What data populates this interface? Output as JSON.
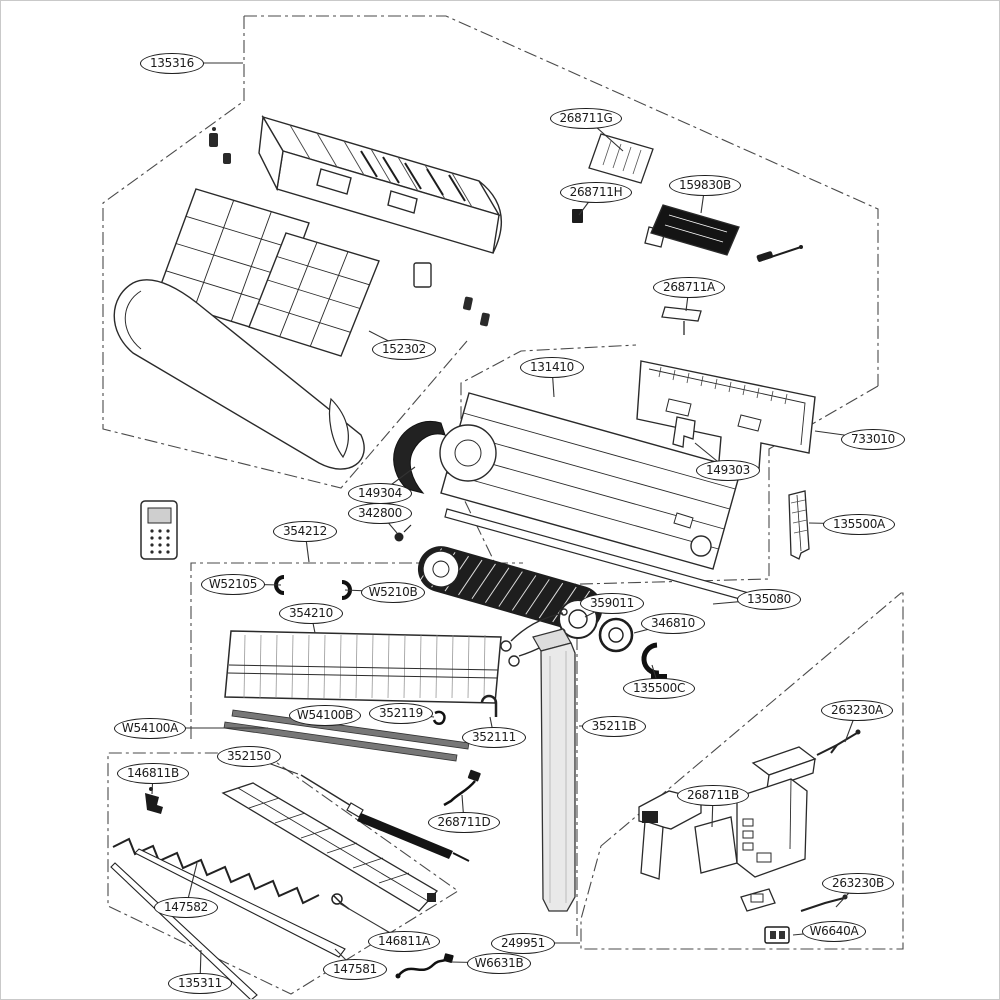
{
  "diagram": {
    "type": "exploded-parts-diagram",
    "labels": [
      {
        "text": "135316",
        "x": 171,
        "y": 62,
        "tx": 242,
        "ty": 62
      },
      {
        "text": "268711G",
        "x": 585,
        "y": 117,
        "tx": 622,
        "ty": 150
      },
      {
        "text": "268711H",
        "x": 595,
        "y": 191,
        "tx": 578,
        "ty": 214
      },
      {
        "text": "159830B",
        "x": 704,
        "y": 184,
        "tx": 700,
        "ty": 212
      },
      {
        "text": "268711A",
        "x": 688,
        "y": 286,
        "tx": 685,
        "ty": 310
      },
      {
        "text": "152302",
        "x": 403,
        "y": 348,
        "tx": 368,
        "ty": 330
      },
      {
        "text": "131410",
        "x": 551,
        "y": 366,
        "tx": 553,
        "ty": 396
      },
      {
        "text": "733010",
        "x": 872,
        "y": 438,
        "tx": 814,
        "ty": 430
      },
      {
        "text": "149303",
        "x": 727,
        "y": 469,
        "tx": 694,
        "ty": 442
      },
      {
        "text": "135500A",
        "x": 858,
        "y": 523,
        "tx": 808,
        "ty": 522
      },
      {
        "text": "149304",
        "x": 379,
        "y": 492,
        "tx": 414,
        "ty": 466
      },
      {
        "text": "342800",
        "x": 379,
        "y": 512,
        "tx": 396,
        "ty": 532
      },
      {
        "text": "354212",
        "x": 304,
        "y": 530,
        "tx": 308,
        "ty": 561
      },
      {
        "text": "W52105",
        "x": 232,
        "y": 583,
        "tx": 280,
        "ty": 584
      },
      {
        "text": "W5210B",
        "x": 392,
        "y": 591,
        "tx": 344,
        "ty": 589
      },
      {
        "text": "354210",
        "x": 310,
        "y": 612,
        "tx": 314,
        "ty": 632
      },
      {
        "text": "359011",
        "x": 611,
        "y": 602,
        "tx": 584,
        "ty": 616
      },
      {
        "text": "135080",
        "x": 768,
        "y": 598,
        "tx": 712,
        "ty": 603
      },
      {
        "text": "346810",
        "x": 672,
        "y": 622,
        "tx": 633,
        "ty": 632
      },
      {
        "text": "135500C",
        "x": 658,
        "y": 687,
        "tx": 651,
        "ty": 664
      },
      {
        "text": "35211B",
        "x": 613,
        "y": 725,
        "tx": 578,
        "ty": 725
      },
      {
        "text": "W54100B",
        "x": 324,
        "y": 714,
        "tx": 329,
        "ty": 722
      },
      {
        "text": "352119",
        "x": 400,
        "y": 712,
        "tx": 433,
        "ty": 716
      },
      {
        "text": "W54100A",
        "x": 149,
        "y": 727,
        "tx": 267,
        "ty": 727
      },
      {
        "text": "352111",
        "x": 493,
        "y": 736,
        "tx": 489,
        "ty": 716
      },
      {
        "text": "352150",
        "x": 248,
        "y": 755,
        "tx": 297,
        "ty": 773
      },
      {
        "text": "146811B",
        "x": 152,
        "y": 772,
        "tx": 151,
        "ty": 793
      },
      {
        "text": "268711D",
        "x": 463,
        "y": 821,
        "tx": 461,
        "ty": 794
      },
      {
        "text": "147582",
        "x": 185,
        "y": 906,
        "tx": 196,
        "ty": 862
      },
      {
        "text": "146811A",
        "x": 403,
        "y": 940,
        "tx": 338,
        "ty": 902
      },
      {
        "text": "147581",
        "x": 354,
        "y": 968,
        "tx": 334,
        "ty": 948
      },
      {
        "text": "135311",
        "x": 199,
        "y": 982,
        "tx": 200,
        "ty": 949
      },
      {
        "text": "263230A",
        "x": 856,
        "y": 709,
        "tx": 844,
        "ty": 741
      },
      {
        "text": "268711B",
        "x": 712,
        "y": 794,
        "tx": 711,
        "ty": 826
      },
      {
        "text": "263230B",
        "x": 857,
        "y": 882,
        "tx": 835,
        "ty": 906
      },
      {
        "text": "W6640A",
        "x": 833,
        "y": 930,
        "tx": 792,
        "ty": 934
      },
      {
        "text": "249951",
        "x": 522,
        "y": 942,
        "tx": 579,
        "ty": 942
      },
      {
        "text": "W6631B",
        "x": 498,
        "y": 962,
        "tx": 450,
        "ty": 961
      }
    ]
  },
  "colors": {
    "line": "#2a2a2a",
    "leader_line": "#333333",
    "boundary_line": "#4a4a4a",
    "label_border": "#1d1d1d",
    "dark_fill": "#1d1d1d",
    "background": "#ffffff"
  }
}
